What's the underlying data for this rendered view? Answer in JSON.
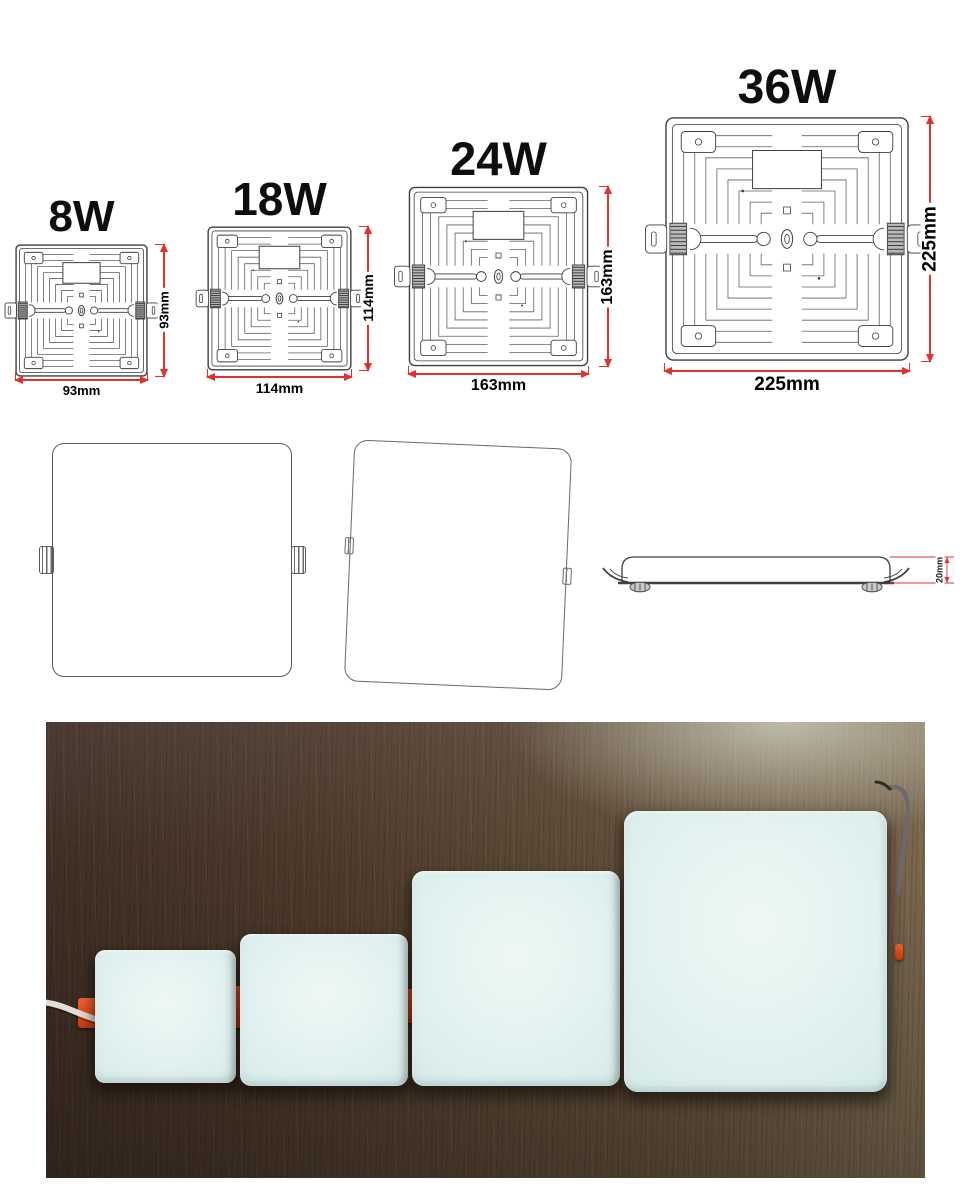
{
  "drawings": {
    "panels": [
      {
        "watt": "8W",
        "width_label": "93mm",
        "height_label": "93mm"
      },
      {
        "watt": "18W",
        "width_label": "114mm",
        "height_label": "114mm"
      },
      {
        "watt": "24W",
        "width_label": "163mm",
        "height_label": "163mm"
      },
      {
        "watt": "36W",
        "width_label": "225mm",
        "height_label": "225mm"
      }
    ],
    "side_view_thickness_label": "20mm"
  },
  "colors": {
    "dimension_red": "#e0312e",
    "drawing_line": "#3f3f3f",
    "clip_orange": "#e64f1e",
    "panel_face_blue": "#d9ecea",
    "wood_dark": "#4a372b"
  }
}
